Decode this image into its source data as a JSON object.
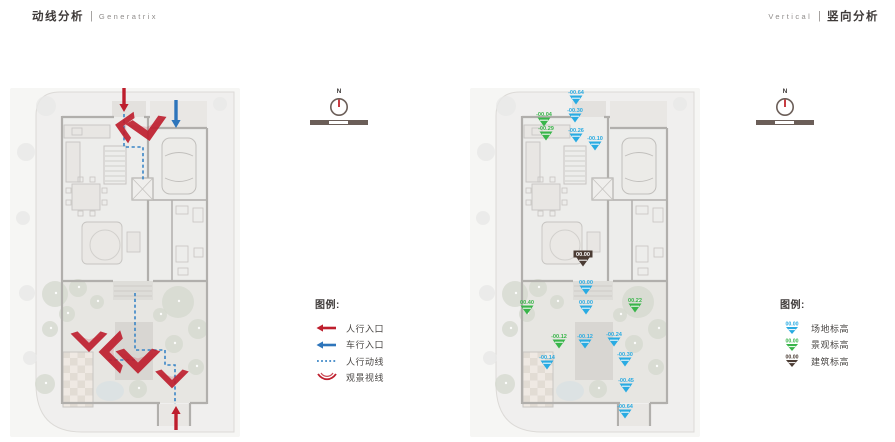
{
  "header": {
    "left": {
      "zh": "动线分析",
      "divider": "|",
      "en": "Generatrix"
    },
    "right": {
      "en": "Vertical",
      "divider": "|",
      "zh": "竖向分析"
    }
  },
  "compass": {
    "north_label": "N"
  },
  "colors": {
    "red": "#be1e2d",
    "arrow_blue": "#2e75bb",
    "path_blue": "#3a85c6",
    "marker_blue": "#29abe2",
    "marker_green": "#39b54a",
    "marker_dark": "#4a3b33"
  },
  "circulation": {
    "legend": {
      "title": "图例:",
      "items": [
        {
          "icon": "arrow-left-red",
          "label": "人行入口"
        },
        {
          "icon": "arrow-left-blue",
          "label": "车行入口"
        },
        {
          "icon": "dotted-line-blue",
          "label": "人行动线"
        },
        {
          "icon": "chevron-red",
          "label": "观景视线"
        }
      ]
    },
    "arrows": [
      {
        "name": "pedestrian-entry-top",
        "color": "red",
        "x": 114,
        "y1": 0,
        "y2": 24
      },
      {
        "name": "vehicle-entry",
        "color": "blue",
        "x": 166,
        "y1": 12,
        "y2": 40
      },
      {
        "name": "pedestrian-entry-bottom",
        "color": "red",
        "x": 166,
        "y1": 342,
        "y2": 318
      }
    ],
    "paths": [
      "114,26 114,59 133,59 133,92",
      "125,205 125,262 155,262 155,277 165,277 165,316",
      "125,272 97,272"
    ],
    "view_chevrons": [
      {
        "x": 112,
        "y": 38,
        "rot": 100,
        "s": 1.0
      },
      {
        "x": 138,
        "y": 44,
        "rot": -10,
        "s": 1.3
      },
      {
        "x": 79,
        "y": 256,
        "rot": 0,
        "s": 1.15
      },
      {
        "x": 98,
        "y": 264,
        "rot": 90,
        "s": 1.35
      },
      {
        "x": 128,
        "y": 276,
        "rot": 0,
        "s": 1.4
      },
      {
        "x": 162,
        "y": 293,
        "rot": 0,
        "s": 1.05
      }
    ]
  },
  "vertical": {
    "legend": {
      "title": "图例:",
      "items": [
        {
          "icon": "marker-blue",
          "value": "00.00",
          "label": "场地标高"
        },
        {
          "icon": "marker-green",
          "value": "00.00",
          "label": "景观标高"
        },
        {
          "icon": "marker-dark",
          "value": "00.00",
          "label": "建筑标高"
        }
      ]
    },
    "markers": [
      {
        "x": 106,
        "y": 6,
        "color": "blue",
        "value": "-00.64"
      },
      {
        "x": 105,
        "y": 24,
        "color": "blue",
        "value": "-00.30"
      },
      {
        "x": 74,
        "y": 28,
        "color": "green",
        "value": "-00.04"
      },
      {
        "x": 76,
        "y": 42,
        "color": "green",
        "value": "-00.29"
      },
      {
        "x": 106,
        "y": 44,
        "color": "blue",
        "value": "-00.26"
      },
      {
        "x": 125,
        "y": 52,
        "color": "blue",
        "value": "-00.10"
      },
      {
        "x": 113,
        "y": 168,
        "color": "dark",
        "value": "00.00"
      },
      {
        "x": 116,
        "y": 196,
        "color": "blue",
        "value": "00.00"
      },
      {
        "x": 116,
        "y": 216,
        "color": "blue",
        "value": "00.00"
      },
      {
        "x": 57,
        "y": 216,
        "color": "green",
        "value": "00.40"
      },
      {
        "x": 165,
        "y": 214,
        "color": "green",
        "value": "00.22"
      },
      {
        "x": 89,
        "y": 250,
        "color": "green",
        "value": "-00.12"
      },
      {
        "x": 115,
        "y": 250,
        "color": "blue",
        "value": "-00.12"
      },
      {
        "x": 144,
        "y": 248,
        "color": "blue",
        "value": "-00.24"
      },
      {
        "x": 77,
        "y": 271,
        "color": "blue",
        "value": "-00.14"
      },
      {
        "x": 155,
        "y": 268,
        "color": "blue",
        "value": "-00.30"
      },
      {
        "x": 156,
        "y": 294,
        "color": "blue",
        "value": "-00.45"
      },
      {
        "x": 155,
        "y": 320,
        "color": "blue",
        "value": "-00.64"
      }
    ]
  }
}
